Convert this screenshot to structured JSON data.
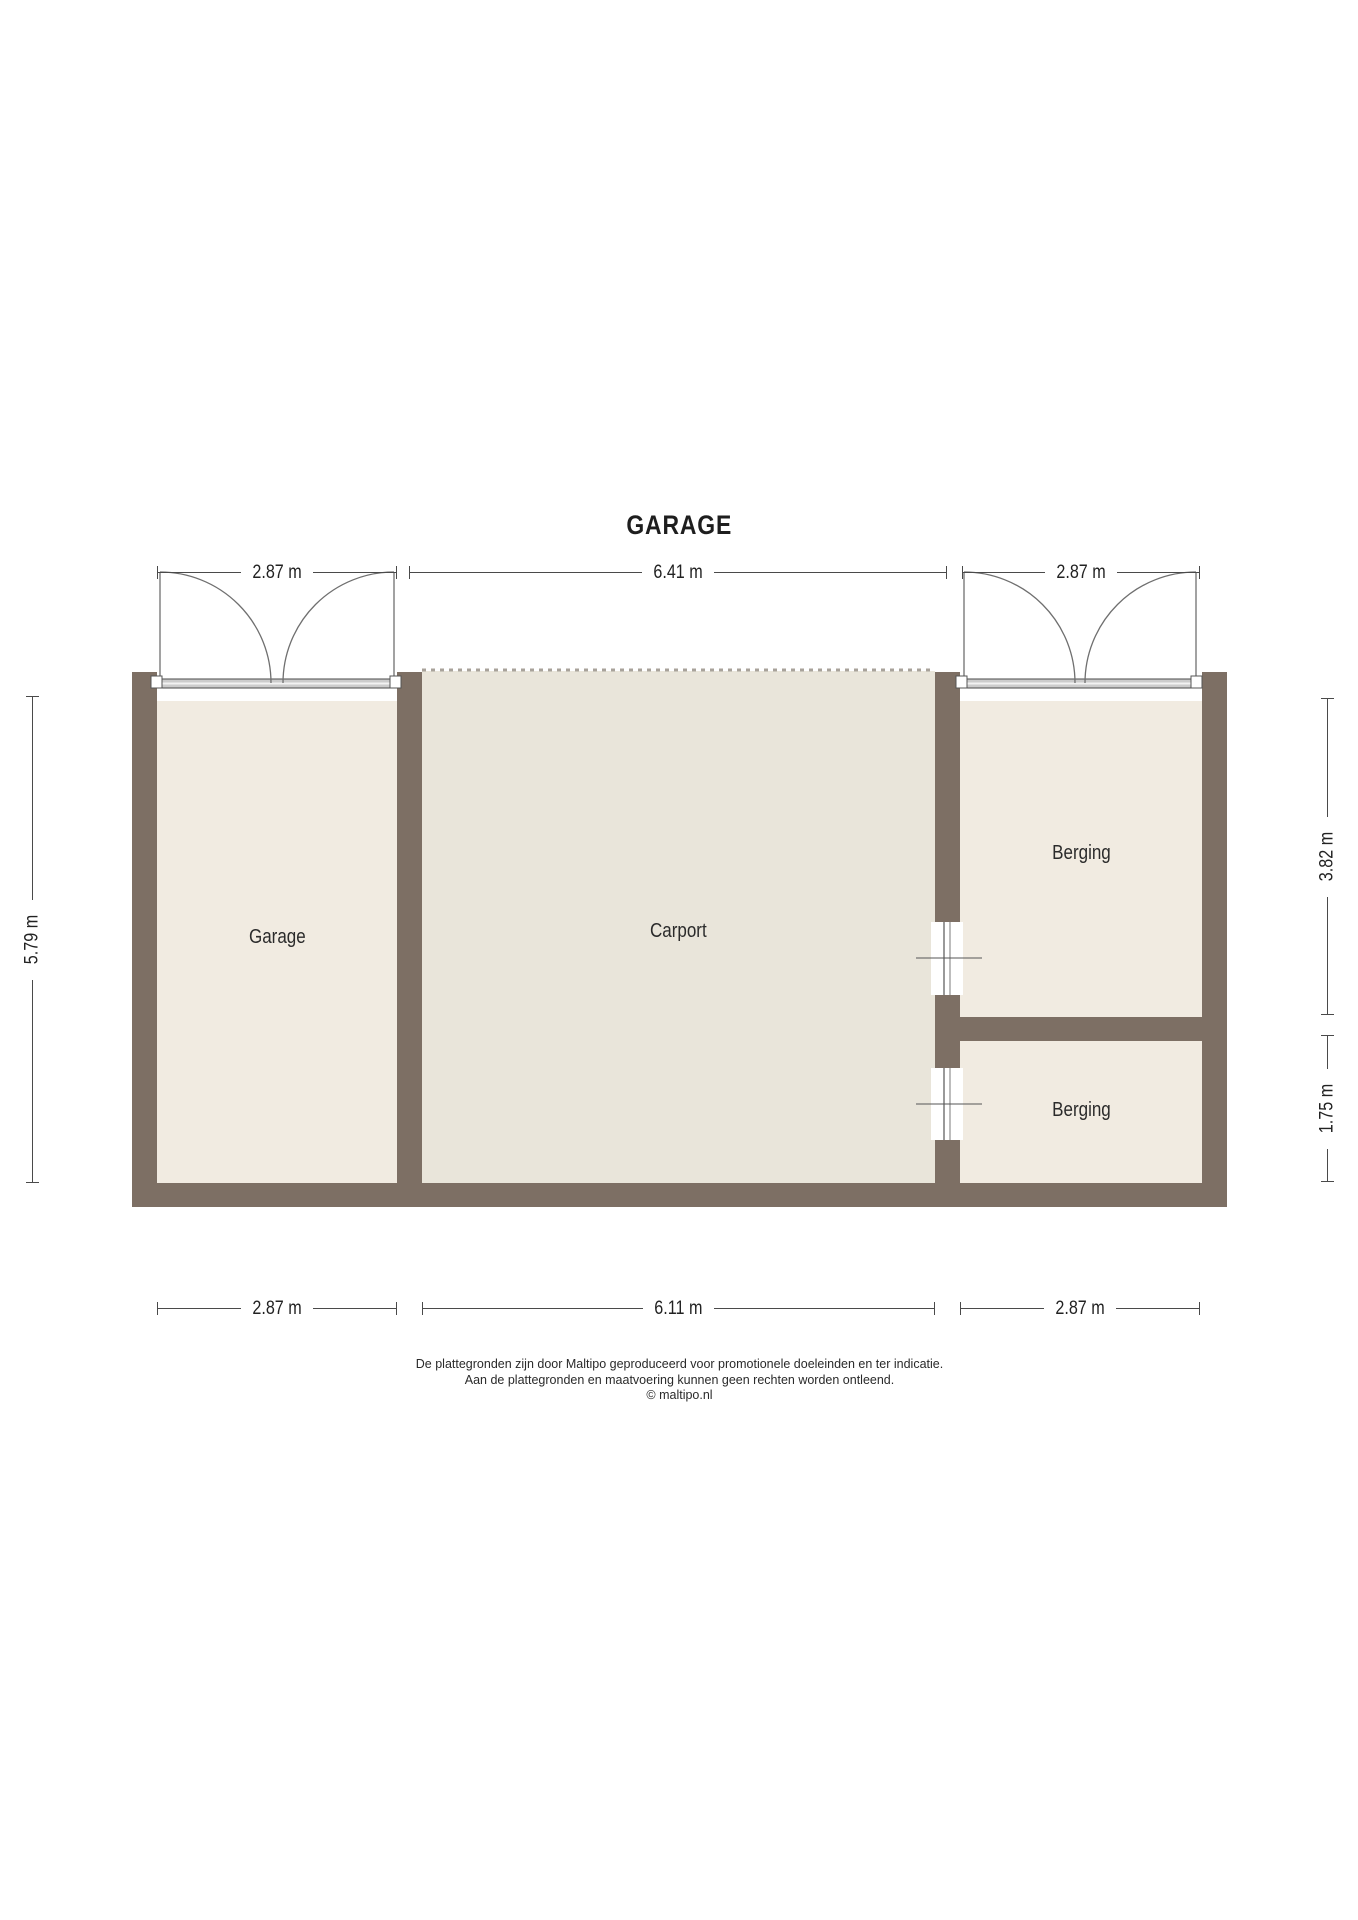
{
  "title": "GARAGE",
  "rooms": {
    "garage": "Garage",
    "carport": "Carport",
    "berging_top": "Berging",
    "berging_bottom": "Berging"
  },
  "dimensions": {
    "top_left": "2.87 m",
    "top_center": "6.41 m",
    "top_right": "2.87 m",
    "left": "5.79 m",
    "right_top": "3.82 m",
    "right_bottom": "1.75 m",
    "bottom_left": "2.87 m",
    "bottom_center": "6.11 m",
    "bottom_right": "2.87 m"
  },
  "footer": {
    "line1": "De plattegronden zijn door Maltipo geproduceerd voor promotionele doeleinden en ter indicatie.",
    "line2": "Aan de plattegronden en maatvoering kunnen geen rechten worden ontleend.",
    "line3": "© maltipo.nl"
  },
  "colors": {
    "wall": "#7d6f64",
    "room_fill": "#f1ebe1",
    "carport_fill": "#e9e5da",
    "dimension_line": "#4a4a4a",
    "open_edge_dash": "#a8a29a"
  }
}
